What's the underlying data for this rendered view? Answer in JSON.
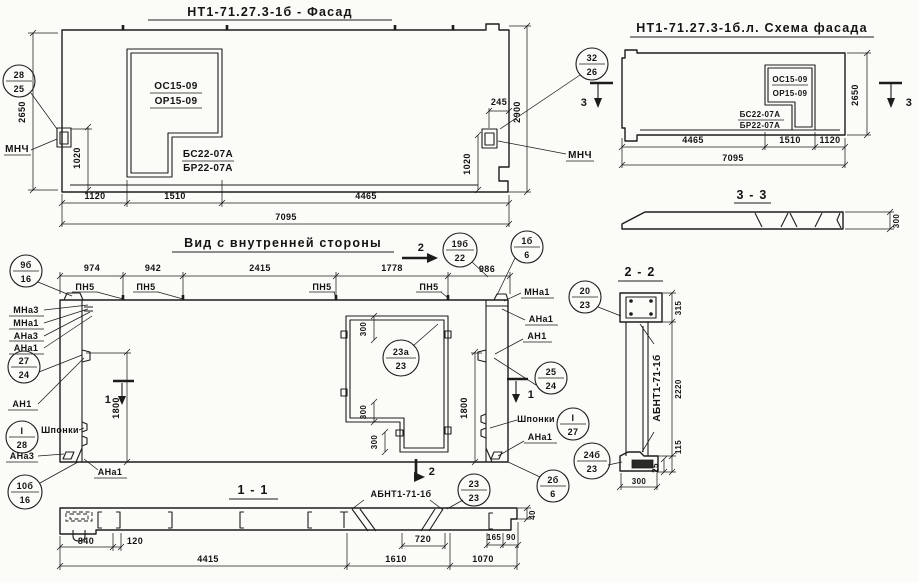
{
  "titles": {
    "facade": "НТ1-71.27.3-1б - Фасад",
    "scheme": "НТ1-71.27.3-1б.л. Схема фасада",
    "inner_view": "Вид с внутренней стороны",
    "section_1_1": "1 - 1",
    "section_2_2": "2 - 2",
    "section_3_3": "3 - 3"
  },
  "marks": {
    "os": "ОС15-09",
    "op": "ОР15-09",
    "bs": "БС22-07А",
    "bp": "БР22-07А",
    "mnch": "МНЧ",
    "pn5": "ПН5",
    "mna3": "МНа3",
    "mna1": "МНа1",
    "ana3": "АНа3",
    "ana1": "АНа1",
    "an1": "АН1",
    "shponki": "Шпонки",
    "abnt": "АБНТ1-71-1б"
  },
  "section_markers": {
    "s1": "1",
    "s2": "2",
    "s3": "3"
  },
  "balloons": {
    "b28_25": {
      "top": "28",
      "bot": "25"
    },
    "b32_26": {
      "top": "32",
      "bot": "26"
    },
    "b9b_16": {
      "top": "9б",
      "bot": "16"
    },
    "b27_24": {
      "top": "27",
      "bot": "24"
    },
    "bI_28": {
      "top": "I",
      "bot": "28"
    },
    "b10b_16": {
      "top": "10б",
      "bot": "16"
    },
    "b23a_23": {
      "top": "23а",
      "bot": "23"
    },
    "b19b_22": {
      "top": "19б",
      "bot": "22"
    },
    "b1b_6": {
      "top": "1б",
      "bot": "6"
    },
    "b25_24": {
      "top": "25",
      "bot": "24"
    },
    "bI_27": {
      "top": "I",
      "bot": "27"
    },
    "b2b_6": {
      "top": "2б",
      "bot": "6"
    },
    "b23_23": {
      "top": "23",
      "bot": "23"
    },
    "b24b_23": {
      "top": "24б",
      "bot": "23"
    },
    "b20_23": {
      "top": "20",
      "bot": "23"
    }
  },
  "dims": {
    "d2650": "2650",
    "d2900": "2900",
    "d1020": "1020",
    "d1120": "1120",
    "d1510": "1510",
    "d4465": "4465",
    "d7095": "7095",
    "d245": "245",
    "d974": "974",
    "d942": "942",
    "d2415": "2415",
    "d1778": "1778",
    "d986": "986",
    "d1800": "1800",
    "d300": "300",
    "d840": "840",
    "d120": "120",
    "d4415": "4415",
    "d720": "720",
    "d1610": "1610",
    "d1070": "1070",
    "d165": "165",
    "d90": "90",
    "d40": "40",
    "d315": "315",
    "d2220": "2220",
    "d115": "115",
    "d25": "25"
  }
}
